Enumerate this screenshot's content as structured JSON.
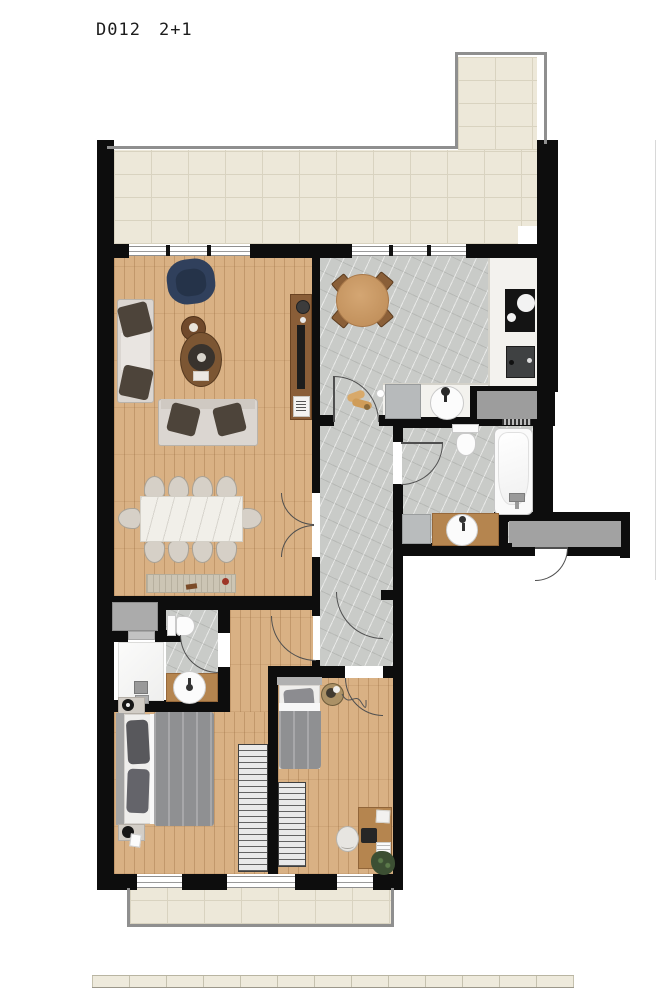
{
  "plan": {
    "title": {
      "unit_code": "D012",
      "unit_type": "2+1"
    },
    "colors": {
      "wall": "#0d0d0d",
      "wood": "#d9b184",
      "marble": "#c9cbc8",
      "tile": "#ede8d9",
      "tile-line": "#d9d3c0",
      "counter": "#f3f2ee",
      "rail": "#8f8f8f",
      "arc": "#4f4f4f",
      "navy": "#30405c",
      "sofa": "#dbd6d1",
      "pillow": "#4d443a",
      "coffee-wood": "#7c5633",
      "oak": "#b5854f",
      "duvet": "#8f9092",
      "landing-gray": "#a2a2a2"
    }
  }
}
